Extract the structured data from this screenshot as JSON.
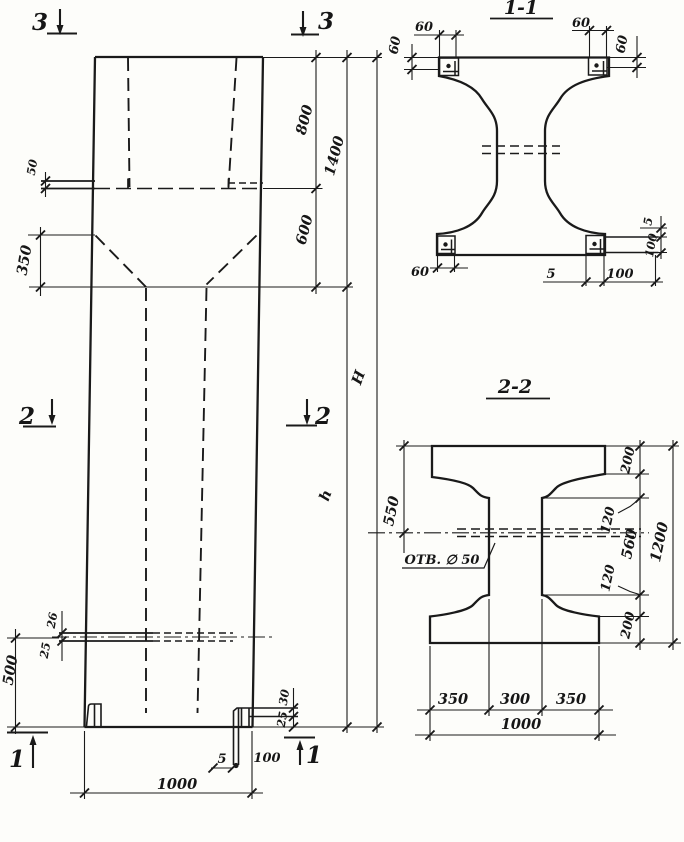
{
  "markers": {
    "s1": "1",
    "s2": "2",
    "s3": "3"
  },
  "elevation": {
    "dim_ledge_50": "50",
    "dim_taper_350": "350",
    "dim_top_800": "800",
    "dim_neck_600": "600",
    "dim_head_1400": "1400",
    "dim_total_H": "H",
    "dim_shaft_h": "h",
    "dim_slot_26": "26",
    "dim_slot_25": "25",
    "dim_slot_500": "500",
    "dim_plate_30": "30",
    "dim_plate_25": "25",
    "dim_base_5": "5",
    "dim_base_100": "100",
    "dim_width_1000": "1000"
  },
  "section_1_1": {
    "title": "1-1",
    "dim_top_left_60": "60",
    "dim_left_60": "60",
    "dim_top_right_60": "60",
    "dim_right_60": "60",
    "dim_bottom_left_60": "60",
    "dim_bottom_5": "5",
    "dim_bottom_100": "100",
    "dim_right_5": "5",
    "dim_right_100": "100"
  },
  "section_2_2": {
    "title": "2-2",
    "hole_label": "ОТВ. ∅ 50",
    "dim_left_550": "550",
    "dim_flange_top_200": "200",
    "dim_taper_top_120": "120",
    "dim_web_560": "560",
    "dim_taper_bottom_120": "120",
    "dim_flange_bottom_200": "200",
    "dim_height_1200": "1200",
    "dim_width_left_350": "350",
    "dim_width_mid_300": "300",
    "dim_width_right_350": "350",
    "dim_width_total_1000": "1000"
  }
}
